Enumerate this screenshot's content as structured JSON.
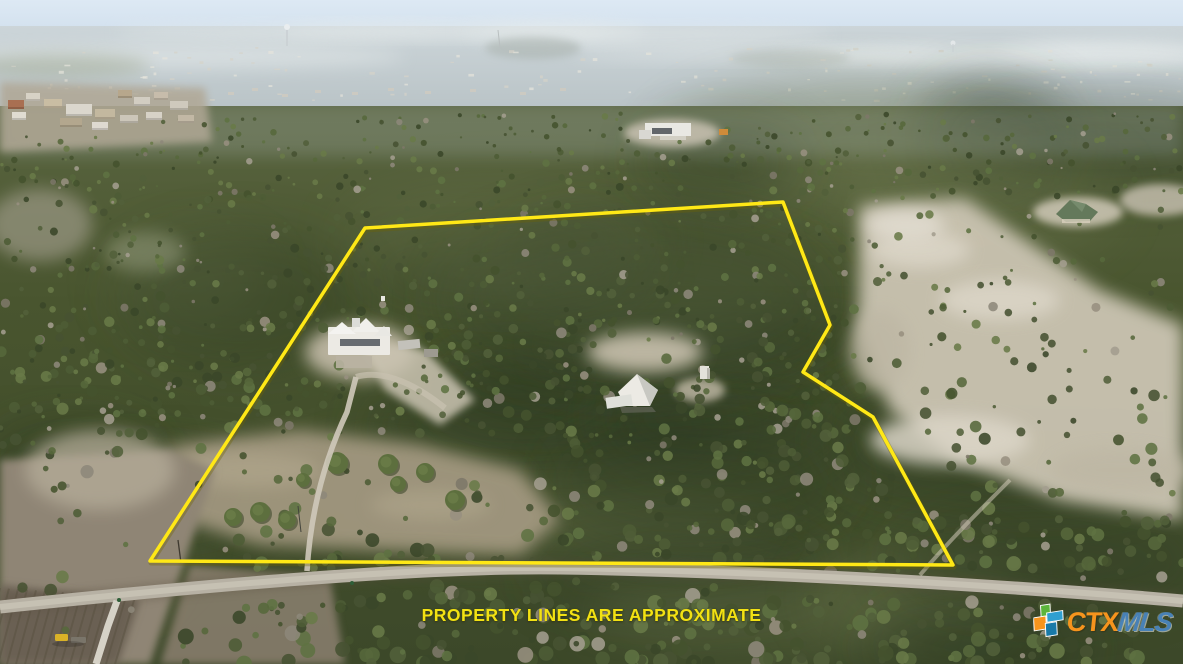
{
  "photo": {
    "kind": "aerial-drone-photo-of-rural-property",
    "features": "wooded acreage with outlined parcel, victorian house, barn, dirt driveway, county road, plowed field, distant town on horizon"
  },
  "disclaimer": {
    "text": "PROPERTY LINES ARE APPROXIMATE",
    "color": "#f2e113"
  },
  "logo": {
    "ctx": "CTX",
    "mls": "MLS",
    "ctx_color": "#f6941d",
    "mls_color": "#4a86c2",
    "icon_colors": {
      "green": "#5cb53c",
      "orange": "#f6941d",
      "blue": "#2f9fd0",
      "teal": "#1879a8"
    }
  },
  "scene": {
    "boundary_color": "#ffe816",
    "boundary_shadow": "#6f6400",
    "boundary_points": [
      [
        150,
        561
      ],
      [
        365,
        228
      ],
      [
        783,
        202
      ],
      [
        830,
        325
      ],
      [
        803,
        372
      ],
      [
        873,
        417
      ],
      [
        953,
        565
      ]
    ],
    "palette": {
      "sky_top": "#dde9f4",
      "sky_low": "#cfdeec",
      "haze_hi": "#ccd5d9",
      "haze_lo": "#b7c1c4",
      "haze_cloud": "#e7ecec",
      "speck_a": "#e6e4dc",
      "speck_b": "#d6d3c9",
      "forest_top": "#5a6540",
      "forest_mid": "#49552f",
      "forest_low": "#3c4829",
      "blob_dark": "#2c3820",
      "blob_light": "#66714a",
      "clearing": "#cbc4b2",
      "clearing_bright": "#dcd6c8",
      "clearing_mid": "#beb7a4",
      "meadow": "#a1977f",
      "meadow_light": "#b0a68c",
      "field": "#8f8574",
      "field_dark": "#6b6152",
      "field_rows": "#57503f",
      "road": "#b7b1a4",
      "road_center": "#c8c3b5",
      "road_shadow": "#5a5041",
      "concrete": "#d6d2c7",
      "house_white": "#eceae4",
      "house_shade": "#c8c8c2",
      "window_dark": "#51565c",
      "roof_green": "#64795b",
      "tree_greens": [
        "#3a4729",
        "#44522e",
        "#4d5c35",
        "#57683b",
        "#5f7242",
        "#697a48",
        "#52603a",
        "#475232"
      ],
      "tree_bare": [
        "#8d887a",
        "#978f7f",
        "#7d7869",
        "#a39d8e"
      ],
      "jeep_yellow": "#d9b227"
    }
  }
}
